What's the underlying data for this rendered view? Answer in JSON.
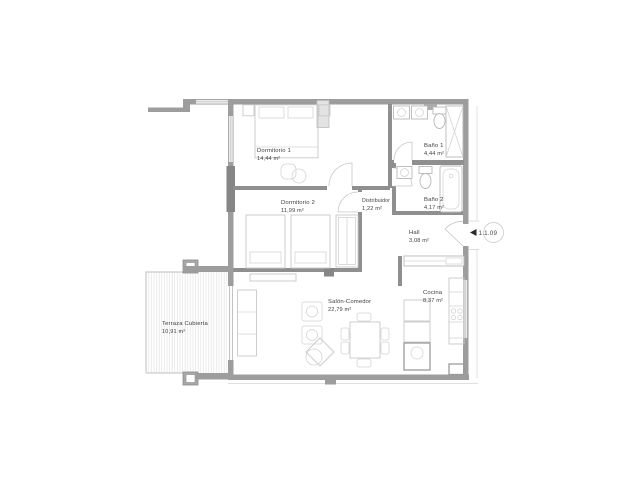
{
  "plan": {
    "unit_label": "1.1.09",
    "rooms": {
      "dormitorio1": {
        "name": "Dormitorio 1",
        "area": "14,44 m²"
      },
      "dormitorio2": {
        "name": "Dormitorio 2",
        "area": "11,99 m²"
      },
      "bano1": {
        "name": "Baño 1",
        "area": "4,44 m²"
      },
      "bano2": {
        "name": "Baño 2",
        "area": "4,17 m²"
      },
      "distribuidor": {
        "name": "Distribuidor",
        "area": "1,22 m²"
      },
      "hall": {
        "name": "Hall",
        "area": "3,08 m²"
      },
      "salon": {
        "name": "Salón-Comedor",
        "area": "22,79 m²"
      },
      "cocina": {
        "name": "Cocina",
        "area": "8,37 m²"
      },
      "terraza": {
        "name": "Terraza Cubierta",
        "area": "10,91 m²"
      }
    },
    "colors": {
      "background": "#ffffff",
      "wall": "#9d9d9d",
      "wall_dark": "#868686",
      "furniture_line": "#c9c9c9",
      "hatch_line": "#e2e2e2",
      "label_text": "#3d3d3d",
      "entrance_marker": "#2a2a2a"
    }
  }
}
